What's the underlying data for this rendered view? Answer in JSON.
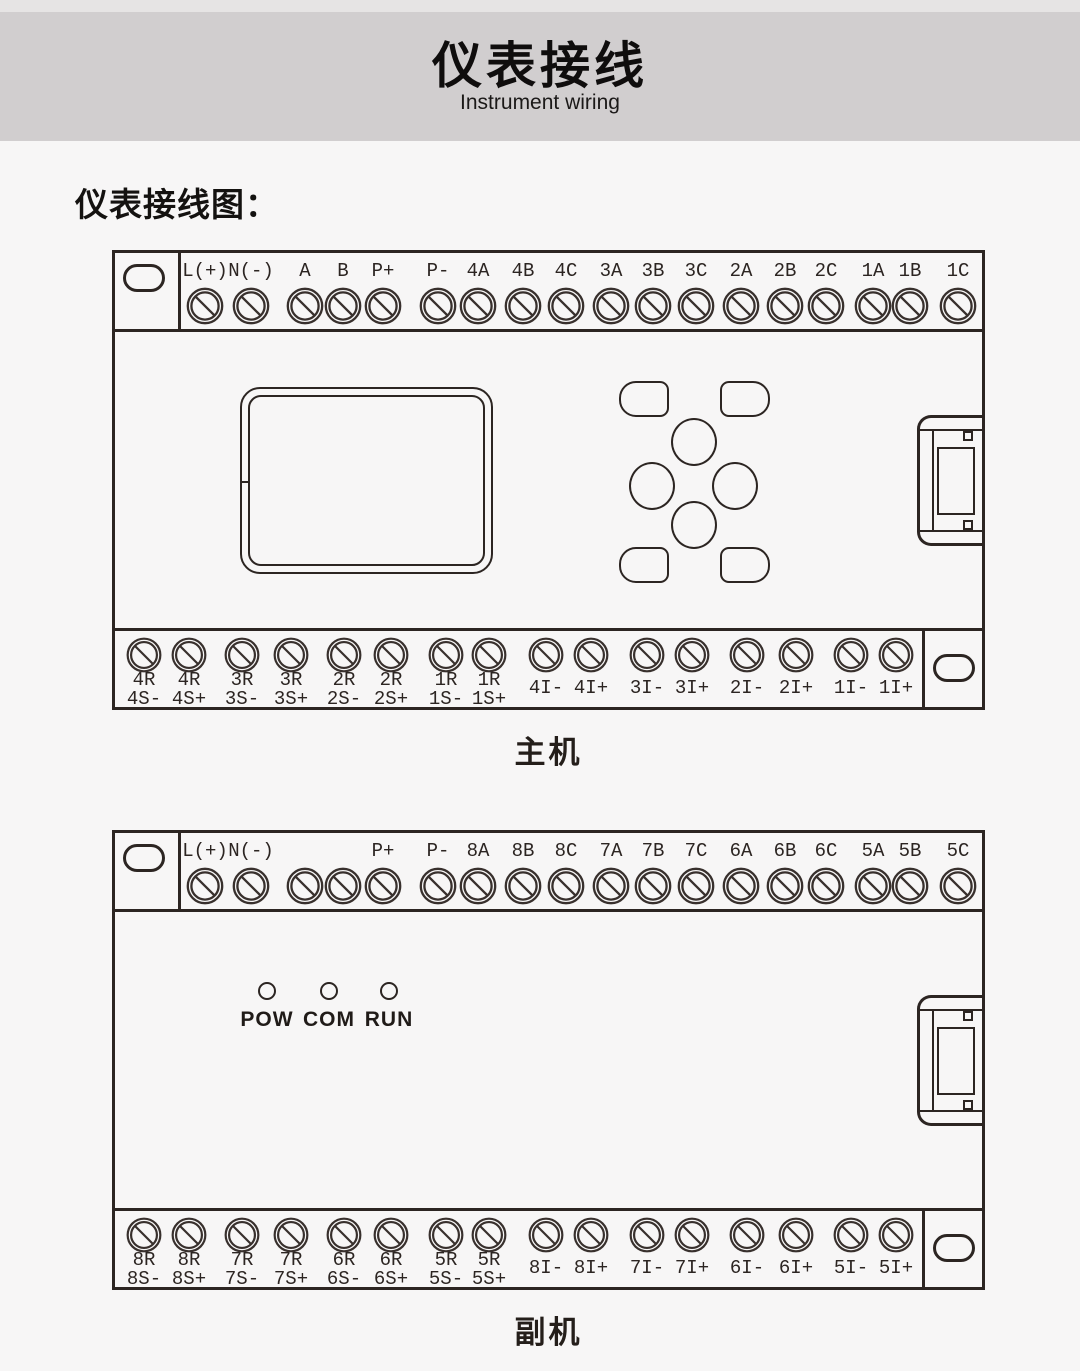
{
  "banner": {
    "title": "仪表接线",
    "subtitle": "Instrument wiring"
  },
  "section_heading": "仪表接线图：",
  "colors": {
    "page_bg": "#f7f6f6",
    "banner_bg": "#d1cecf",
    "topbar_bg": "#e6e4e4",
    "line": "#2c2522",
    "screw": "#38302d",
    "text": "#171411"
  },
  "icons": {
    "screw": "terminal-screw-icon",
    "oval": "mounting-slot-icon",
    "connector": "side-connector-icon"
  },
  "devices": [
    {
      "name": "主机",
      "top_terminals": [
        "L(+)",
        "N(-)",
        "A",
        "B",
        "P+",
        "P-",
        "4A",
        "4B",
        "4C",
        "3A",
        "3B",
        "3C",
        "2A",
        "2B",
        "2C",
        "1A",
        "1B",
        "1C"
      ],
      "bottom_terminals": [
        [
          "4R",
          "4S-"
        ],
        [
          "4R",
          "4S+"
        ],
        [
          "3R",
          "3S-"
        ],
        [
          "3R",
          "3S+"
        ],
        [
          "2R",
          "2S-"
        ],
        [
          "2R",
          "2S+"
        ],
        [
          "1R",
          "1S-"
        ],
        [
          "1R",
          "1S+"
        ],
        [
          "4I-"
        ],
        [
          "4I+"
        ],
        [
          "3I-"
        ],
        [
          "3I+"
        ],
        [
          "2I-"
        ],
        [
          "2I+"
        ],
        [
          "1I-"
        ],
        [
          "1I+"
        ]
      ],
      "display": true,
      "keypad": true,
      "leds": null
    },
    {
      "name": "副机",
      "top_terminals": [
        "L(+)",
        "N(-)",
        "",
        "",
        "P+",
        "P-",
        "8A",
        "8B",
        "8C",
        "7A",
        "7B",
        "7C",
        "6A",
        "6B",
        "6C",
        "5A",
        "5B",
        "5C"
      ],
      "bottom_terminals": [
        [
          "8R",
          "8S-"
        ],
        [
          "8R",
          "8S+"
        ],
        [
          "7R",
          "7S-"
        ],
        [
          "7R",
          "7S+"
        ],
        [
          "6R",
          "6S-"
        ],
        [
          "6R",
          "6S+"
        ],
        [
          "5R",
          "5S-"
        ],
        [
          "5R",
          "5S+"
        ],
        [
          "8I-"
        ],
        [
          "8I+"
        ],
        [
          "7I-"
        ],
        [
          "7I+"
        ],
        [
          "6I-"
        ],
        [
          "6I+"
        ],
        [
          "5I-"
        ],
        [
          "5I+"
        ]
      ],
      "display": false,
      "keypad": false,
      "leds": [
        "POW",
        "COM",
        "RUN"
      ]
    }
  ]
}
